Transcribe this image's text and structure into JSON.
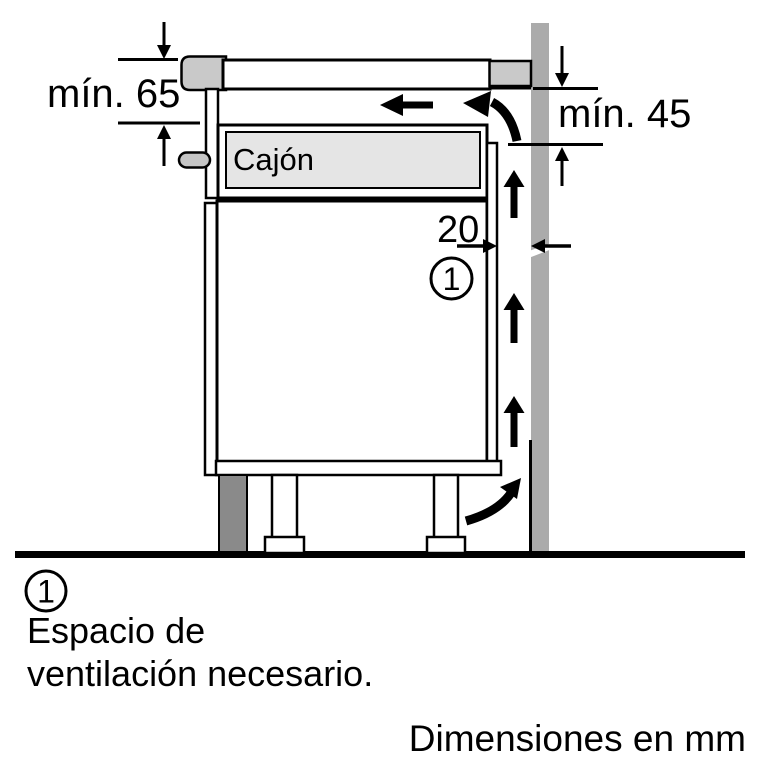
{
  "diagram": {
    "drawer_label": "Cajón",
    "dim_min65": "mín. 65",
    "dim_min45": "mín. 45",
    "dim_gap": "20",
    "callout": "1"
  },
  "legend": {
    "callout": "1",
    "line1": "Espacio de",
    "line2": "ventilación necesario."
  },
  "footer": {
    "text": "Dimensiones en mm"
  },
  "colors": {
    "wall": "#ababab",
    "hob_gray": "#c9c9c9",
    "peg": "#c5c5c5",
    "drawer_fill": "#e5e5e5",
    "plinth": "#8a8a8a",
    "line": "#000000"
  }
}
